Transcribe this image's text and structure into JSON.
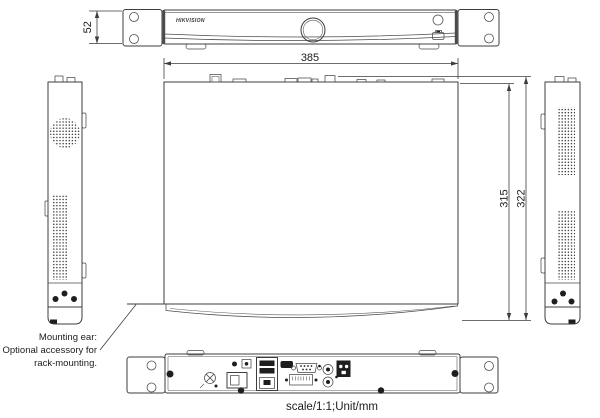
{
  "drawing": {
    "brand_logo": "HIKVISION",
    "dimensions": {
      "front_height": "52",
      "width": "385",
      "depth_chassis": "315",
      "depth_total": "322"
    },
    "note": {
      "line1": "Mounting ear:",
      "line2": "Optional accessory for",
      "line3": "rack-mounting."
    },
    "caption": "scale/1:1;Unit/mm",
    "colors": {
      "line": "#3d3d3d",
      "dark_fill": "#1e1e1e",
      "background": "#ffffff"
    }
  }
}
